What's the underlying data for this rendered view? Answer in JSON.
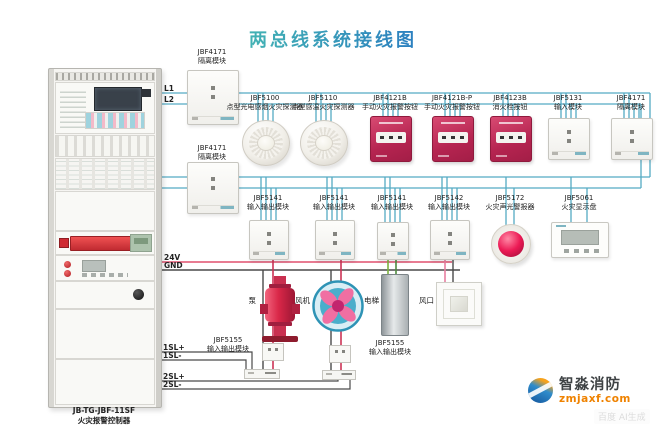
{
  "title": "两总线系统接线图",
  "controller": {
    "model": "JB-TG-JBF-11SF",
    "name": "火灾报警控制器"
  },
  "wire_labels": {
    "l1": "L1",
    "l2": "L2",
    "v24": "24V",
    "gnd": "GND",
    "sl1_plus": "1SL+",
    "sl1_minus": "1SL-",
    "sl2_plus": "2SL+",
    "sl2_minus": "2SL-"
  },
  "isolators": {
    "top": {
      "model": "JBF4171",
      "name": "隔离模块"
    },
    "mid": {
      "model": "JBF4171",
      "name": "隔离模块"
    }
  },
  "row1": [
    {
      "model": "JBF5100",
      "name": "点型光电感烟火灾探测器",
      "icon": "smoke-detector"
    },
    {
      "model": "JBF5110",
      "name": "点型感温火灾探测器",
      "icon": "heat-detector"
    },
    {
      "model": "JBF4121B",
      "name": "手动火灾报警按钮",
      "icon": "manual-call-point"
    },
    {
      "model": "JBF4121B-P",
      "name": "手动火灾报警按钮",
      "icon": "manual-call-point"
    },
    {
      "model": "JBF4123B",
      "name": "消火栓按钮",
      "icon": "hydrant-button"
    },
    {
      "model": "JBF5131",
      "name": "输入模块",
      "icon": "io-module"
    },
    {
      "model": "JBF4171",
      "name": "隔离模块",
      "icon": "isolator-module"
    }
  ],
  "row2": [
    {
      "model": "JBF5141",
      "name": "输入输出模块",
      "icon": "io-module"
    },
    {
      "model": "JBF5141",
      "name": "输入输出模块",
      "icon": "io-module"
    },
    {
      "model": "JBF5141",
      "name": "输入输出模块",
      "icon": "io-module"
    },
    {
      "model": "JBF5142",
      "name": "输入输出模块",
      "icon": "io-module"
    },
    {
      "model": "JBF5172",
      "name": "火灾声光警报器",
      "icon": "sounder-strobe"
    },
    {
      "model": "JBF5061",
      "name": "火灾显示盘",
      "icon": "display-panel"
    }
  ],
  "equipment": [
    {
      "label": "泵",
      "icon": "pump"
    },
    {
      "label": "风机",
      "icon": "fan"
    },
    {
      "label": "电梯",
      "icon": "elevator"
    },
    {
      "label": "风口",
      "icon": "air-vent"
    }
  ],
  "output_modules": {
    "left": {
      "model": "JBF5155",
      "name": "输入输出模块"
    },
    "right": {
      "model": "JBF5155",
      "name": "输入输出模块"
    }
  },
  "brand": {
    "name": "智淼消防",
    "site": "zmjaxf.com",
    "watermark": "百度 AI生成"
  },
  "colors": {
    "title": "#2d9ec4",
    "bus": "#55abc4",
    "power_24v": "#e0506e",
    "ground": "#4a4a4a",
    "device_red": "#c22c50"
  }
}
